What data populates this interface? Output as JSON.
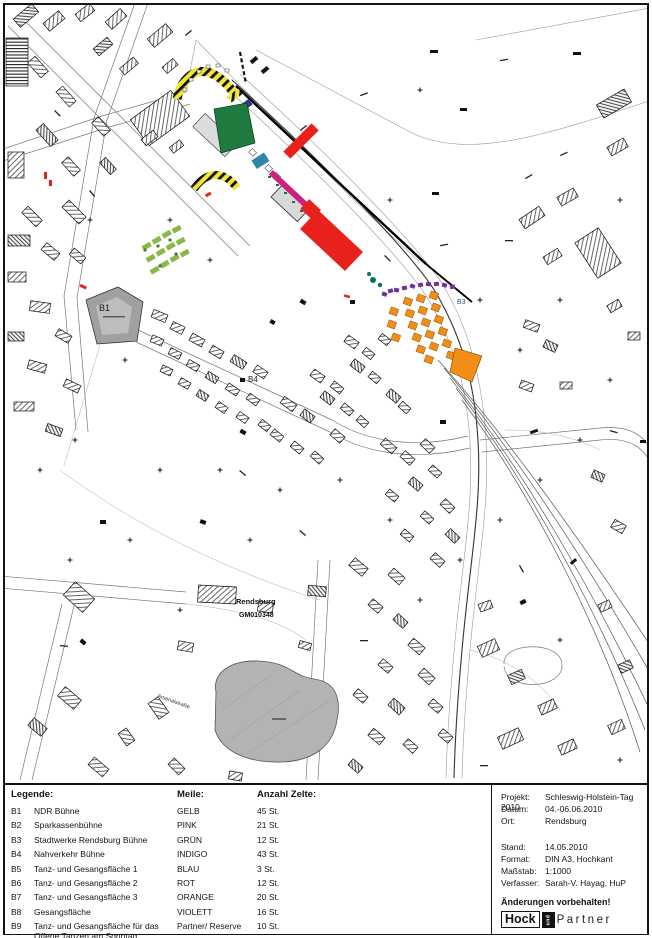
{
  "colors": {
    "gelb": "#f2e535",
    "pink": "#c8247f",
    "gruen": "#1e7a3e",
    "indigo": "#35339b",
    "blau": "#2e86ab",
    "rot": "#e8211d",
    "orange": "#f28d15",
    "violett": "#7030a0",
    "teal": "#0f6e62",
    "parkgreen": "#8ab84a",
    "parkdark": "#3e7d32"
  },
  "map": {
    "labels": {
      "b1": "B1",
      "b3": "B3",
      "b4": "B4",
      "place": "Rendsburg",
      "code": "GM010348",
      "street": "Arsenalstraße"
    }
  },
  "legend": {
    "title": "Legende:",
    "col_meile": "Meile:",
    "col_anzahl": "Anzahl Zelte:",
    "rows": [
      {
        "code": "B1",
        "desc": "NDR Bühne",
        "meile": "GELB",
        "anzahl": "45 St."
      },
      {
        "code": "B2",
        "desc": "Sparkassenbühne",
        "meile": "PINK",
        "anzahl": "21 St."
      },
      {
        "code": "B3",
        "desc": "Stadtwerke Rendsburg Bühne",
        "meile": "GRÜN",
        "anzahl": "12 St."
      },
      {
        "code": "B4",
        "desc": "Nahverkehr Bühne",
        "meile": "INDIGO",
        "anzahl": "43 St."
      },
      {
        "code": "B5",
        "desc": "Tanz- und Gesangsfläche 1",
        "meile": "BLAU",
        "anzahl": "3 St."
      },
      {
        "code": "B6",
        "desc": "Tanz- und Gesangsfläche 2",
        "meile": "ROT",
        "anzahl": "12 St."
      },
      {
        "code": "B7",
        "desc": "Tanz- und Gesangsfläche 3",
        "meile": "ORANGE",
        "anzahl": "20 St."
      },
      {
        "code": "B8",
        "desc": "Gesangsfläche",
        "meile": "VIOLETT",
        "anzahl": "16 St."
      },
      {
        "code": "B9",
        "desc": "Tanz- und Gesangsfläche für das Offene Tanzen am Sonntag, 06.06.2010",
        "meile": "Partner/ Reserve",
        "anzahl": "10 St."
      }
    ]
  },
  "info": {
    "rows": [
      {
        "label": "Projekt:",
        "value": "Schleswig-Holstein-Tag 2010"
      },
      {
        "label": "Datum:",
        "value": "04.-06.06.2010"
      },
      {
        "label": "Ort:",
        "value": "Rendsburg"
      },
      {
        "label": "Stand:",
        "value": "14.05.2010"
      },
      {
        "label": "Format:",
        "value": "DIN A3, Hochkant"
      },
      {
        "label": "Maßstab:",
        "value": "1:1000"
      },
      {
        "label": "Verfasser:",
        "value": "Sarah-V. Hayag, HuP"
      }
    ],
    "notice": "Änderungen vorbehalten!",
    "logo": {
      "part1": "Hock",
      "part2": "und",
      "part3": "Partner"
    }
  }
}
